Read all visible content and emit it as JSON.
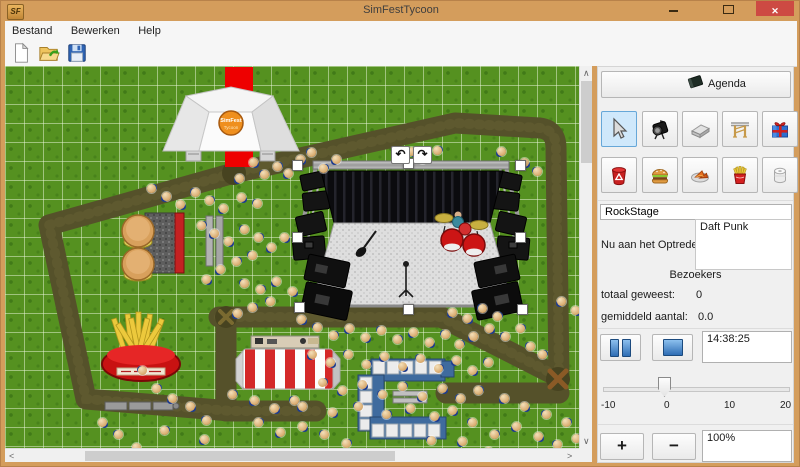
{
  "window": {
    "title": "SimFestTycoon",
    "icon_text": "SF",
    "minimize": "minimize",
    "maximize": "maximize",
    "close": "✕"
  },
  "menu": {
    "items": [
      "Bestand",
      "Bewerken",
      "Help"
    ]
  },
  "toolbar": {
    "buttons": [
      "new-file",
      "open-file",
      "save-file"
    ]
  },
  "canvas": {
    "rotate_left": "↶",
    "rotate_right": "↷",
    "stage_logo": "SimFest",
    "stage_logo_sub": "Tycoon",
    "crowd": [
      [
        238,
        177
      ],
      [
        252,
        161
      ],
      [
        263,
        173
      ],
      [
        276,
        165
      ],
      [
        287,
        172
      ],
      [
        299,
        158
      ],
      [
        310,
        151
      ],
      [
        322,
        167
      ],
      [
        335,
        158
      ],
      [
        410,
        150
      ],
      [
        421,
        158
      ],
      [
        436,
        149
      ],
      [
        500,
        150
      ],
      [
        523,
        161
      ],
      [
        536,
        170
      ],
      [
        150,
        187
      ],
      [
        165,
        195
      ],
      [
        179,
        203
      ],
      [
        194,
        191
      ],
      [
        208,
        199
      ],
      [
        222,
        207
      ],
      [
        240,
        196
      ],
      [
        256,
        202
      ],
      [
        200,
        224
      ],
      [
        213,
        232
      ],
      [
        227,
        240
      ],
      [
        243,
        228
      ],
      [
        257,
        236
      ],
      [
        270,
        246
      ],
      [
        283,
        236
      ],
      [
        251,
        254
      ],
      [
        235,
        260
      ],
      [
        219,
        268
      ],
      [
        205,
        278
      ],
      [
        243,
        282
      ],
      [
        259,
        288
      ],
      [
        275,
        280
      ],
      [
        291,
        290
      ],
      [
        269,
        300
      ],
      [
        251,
        306
      ],
      [
        236,
        312
      ],
      [
        300,
        318
      ],
      [
        316,
        326
      ],
      [
        332,
        334
      ],
      [
        348,
        327
      ],
      [
        364,
        336
      ],
      [
        380,
        329
      ],
      [
        396,
        338
      ],
      [
        412,
        331
      ],
      [
        428,
        341
      ],
      [
        444,
        333
      ],
      [
        458,
        343
      ],
      [
        472,
        335
      ],
      [
        488,
        327
      ],
      [
        504,
        335
      ],
      [
        519,
        327
      ],
      [
        311,
        353
      ],
      [
        329,
        361
      ],
      [
        347,
        353
      ],
      [
        365,
        363
      ],
      [
        383,
        355
      ],
      [
        401,
        365
      ],
      [
        419,
        357
      ],
      [
        437,
        367
      ],
      [
        455,
        359
      ],
      [
        471,
        369
      ],
      [
        487,
        361
      ],
      [
        321,
        381
      ],
      [
        341,
        389
      ],
      [
        361,
        383
      ],
      [
        381,
        393
      ],
      [
        401,
        385
      ],
      [
        421,
        395
      ],
      [
        441,
        387
      ],
      [
        459,
        397
      ],
      [
        477,
        389
      ],
      [
        301,
        405
      ],
      [
        331,
        411
      ],
      [
        357,
        405
      ],
      [
        385,
        413
      ],
      [
        409,
        407
      ],
      [
        433,
        415
      ],
      [
        141,
        369
      ],
      [
        155,
        387
      ],
      [
        171,
        397
      ],
      [
        189,
        405
      ],
      [
        205,
        419
      ],
      [
        163,
        429
      ],
      [
        135,
        446
      ],
      [
        101,
        421
      ],
      [
        117,
        433
      ],
      [
        231,
        393
      ],
      [
        253,
        399
      ],
      [
        273,
        407
      ],
      [
        293,
        399
      ],
      [
        257,
        421
      ],
      [
        279,
        431
      ],
      [
        301,
        425
      ],
      [
        323,
        433
      ],
      [
        345,
        442
      ],
      [
        203,
        438
      ],
      [
        451,
        409
      ],
      [
        471,
        421
      ],
      [
        493,
        433
      ],
      [
        515,
        425
      ],
      [
        537,
        435
      ],
      [
        556,
        443
      ],
      [
        575,
        437
      ],
      [
        503,
        397
      ],
      [
        523,
        405
      ],
      [
        545,
        413
      ],
      [
        565,
        421
      ],
      [
        451,
        311
      ],
      [
        466,
        317
      ],
      [
        481,
        307
      ],
      [
        496,
        315
      ],
      [
        560,
        300
      ],
      [
        574,
        309
      ],
      [
        529,
        345
      ],
      [
        541,
        353
      ],
      [
        461,
        440
      ],
      [
        487,
        450
      ],
      [
        430,
        439
      ]
    ]
  },
  "panel": {
    "agenda_label": "Agenda",
    "tools": {
      "row1": [
        "select",
        "spotlight",
        "stage",
        "truss",
        "gift"
      ],
      "row2": [
        "trash",
        "burger",
        "snack",
        "fries",
        "toilet-roll"
      ],
      "selected": "select"
    },
    "stage_name": "RockStage",
    "now_playing_label": "Nu aan het Optreden:",
    "now_playing": "Daft Punk",
    "visitors": {
      "header": "Bezoekers",
      "total_label": "totaal geweest:",
      "total_value": "0",
      "avg_label": "gemiddeld aantal:",
      "avg_value": "0.0"
    },
    "time": "14:38:25",
    "slider": {
      "min": -10,
      "max": 20,
      "value": 0,
      "ticks": [
        "-10",
        "0",
        "10",
        "20"
      ]
    },
    "zoom_value": "100%",
    "plus_label": "+",
    "minus_label": "−"
  },
  "colors": {
    "titlebar": "#d49d5c",
    "close_button": "#cd4a43",
    "grass": "#559120",
    "path": "#55512a",
    "carpet": "#ee0000",
    "selected_tool_bg": "#cfe8fb"
  }
}
